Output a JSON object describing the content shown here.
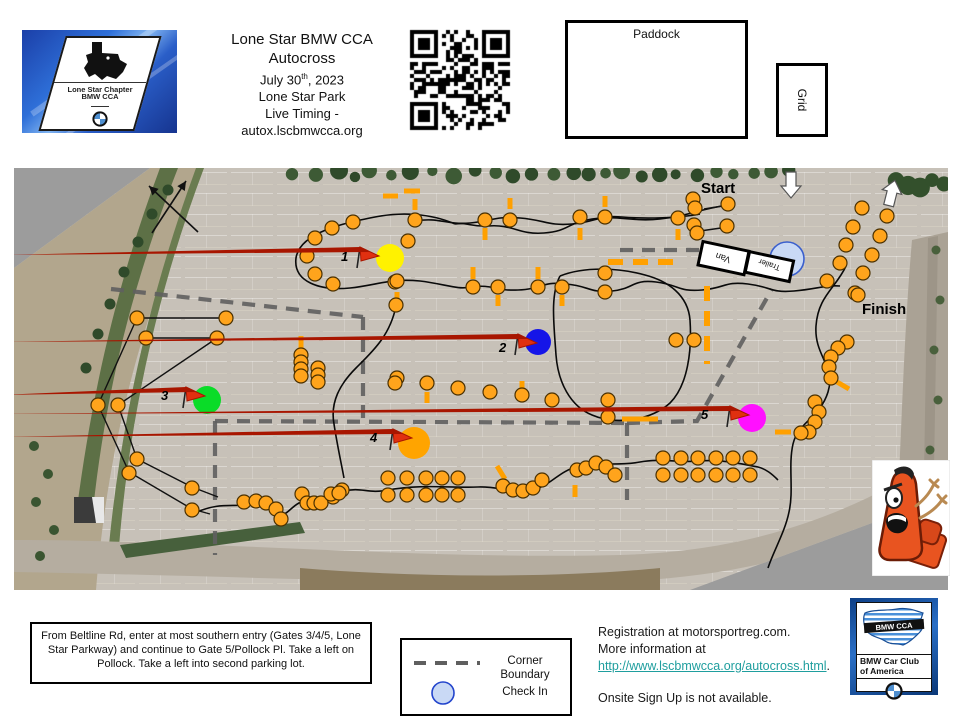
{
  "header": {
    "title_line1": "Lone Star BMW CCA",
    "title_line2": "Autocross",
    "date_prefix": "July 30",
    "date_sup": "th",
    "date_suffix": ", 2023",
    "venue": "Lone Star Park",
    "timing_label": "Live Timing -",
    "timing_url": "autox.lscbmwcca.org",
    "paddock_label": "Paddock",
    "grid_label": "Grid",
    "club_logo_line1": "Lone Star Chapter",
    "club_logo_line2": "BMW CCA"
  },
  "map": {
    "labels": {
      "start": "Start",
      "finish": "Finish",
      "van": "Van",
      "trailer": "Trailer"
    },
    "colors": {
      "cone": "#FFA41C",
      "cone_stroke": "#4a3000",
      "dash": "#FFA000",
      "boundary": "#5f5f5f",
      "course": "#0a0a0a",
      "checkin_fill": "#C9D9F5",
      "checkin_stroke": "#3A5FCD",
      "flag": "#E03010",
      "flag_dark": "#A81600"
    },
    "stations": [
      {
        "n": "1",
        "x": 390,
        "y": 258,
        "r": 14,
        "color": "#FFF200",
        "flag": [
          357,
          268
        ],
        "num": [
          341,
          261
        ]
      },
      {
        "n": "2",
        "x": 538,
        "y": 342,
        "r": 13,
        "color": "#1515E8",
        "flag": [
          515,
          355
        ],
        "num": [
          499,
          352
        ]
      },
      {
        "n": "3",
        "x": 207,
        "y": 400,
        "r": 14,
        "color": "#0ADC28",
        "flag": [
          183,
          408
        ],
        "num": [
          161,
          400
        ]
      },
      {
        "n": "4",
        "x": 414,
        "y": 443,
        "r": 16,
        "color": "#FFA400",
        "flag": [
          390,
          450
        ],
        "num": [
          370,
          442
        ]
      },
      {
        "n": "5",
        "x": 752,
        "y": 418,
        "r": 14,
        "color": "#FF10FF",
        "flag": [
          727,
          427
        ],
        "num": [
          701,
          419
        ]
      }
    ],
    "checkin": {
      "x": 787,
      "y": 259,
      "r": 17
    },
    "van_box": {
      "x": 700,
      "y": 246,
      "w": 47,
      "h": 24,
      "rot": 12
    },
    "trailer_box": {
      "x": 747,
      "y": 256,
      "w": 45,
      "h": 21,
      "rot": 12
    },
    "start_label_pos": [
      701,
      193
    ],
    "finish_label_pos": [
      862,
      314
    ],
    "white_arrows": [
      {
        "x": 791,
        "y": 186,
        "dir": "down",
        "rot": 0
      },
      {
        "x": 892,
        "y": 192,
        "dir": "up",
        "rot": 14
      }
    ],
    "cross_arrows": [
      [
        152,
        233,
        186,
        181
      ],
      [
        198,
        232,
        149,
        186
      ]
    ],
    "boundaries": [
      [
        [
          111,
          289
        ],
        [
          363,
          317
        ]
      ],
      [
        [
          363,
          317
        ],
        [
          363,
          423
        ]
      ],
      [
        [
          215,
          421
        ],
        [
          627,
          423
        ]
      ],
      [
        [
          215,
          421
        ],
        [
          215,
          555
        ]
      ],
      [
        [
          627,
          423
        ],
        [
          627,
          500
        ]
      ],
      [
        [
          627,
          423
        ],
        [
          697,
          421
        ],
        [
          772,
          289
        ]
      ],
      [
        [
          620,
          250
        ],
        [
          700,
          250
        ]
      ]
    ],
    "course_paths": [
      "M728,205 C700,209 688,216 660,219 C632,222 618,215 592,219 C566,223 570,231 544,233 C518,235 514,224 488,226 C470,227 468,222 455,224",
      "M455,224 C430,213 400,212 375,217 C345,223 300,232 296,258 C293,282 320,291 350,288 C378,285 390,278 420,281 C445,284 458,290 470,287 C495,284 492,291 518,290 C544,289 540,281 566,284 C590,286 588,293 612,291 C634,289 632,279 656,282 C680,285 678,292 702,290 C726,288 724,281 748,284 C772,287 770,293 794,291 C818,289 824,285 840,286",
      "M415,221 C440,217 445,225 470,223 C492,221 495,216 520,218 C545,220 548,226 572,224 C596,222 598,215 622,217 C646,219 680,218 700,214",
      "M560,276 C585,266 620,268 645,275 C668,281 688,295 690,320 C692,350 688,385 670,403 C650,421 615,425 592,415 C570,406 558,382 556,355 C554,325 550,295 560,276",
      "M846,266 C836,288 818,296 816,326 C814,356 836,366 828,392 C820,418 798,422 793,444 C788,466 794,490 789,512 C785,532 773,552 768,568",
      "M195,513 C220,501 236,508 250,504 C264,500 268,509 278,514 C288,519 293,499 310,501 C325,503 330,494 344,491 C362,487 368,494 388,490 C420,484 450,488 478,487 C500,486 516,495 536,489 C552,484 560,470 580,466 C600,462 620,466 640,462 C660,458 680,463 700,461 C720,459 742,464 758,467 C766,469 772,474 778,480",
      "M396,306 C390,336 372,352 356,368 C340,384 330,402 334,424 C337,444 341,462 344,478"
    ],
    "gate_lines": [
      [
        137,
        318,
        226,
        318
      ],
      [
        146,
        338,
        217,
        338
      ],
      [
        704,
        209,
        729,
        205
      ],
      [
        700,
        231,
        728,
        227
      ],
      [
        137,
        318,
        98,
        405
      ],
      [
        217,
        338,
        118,
        405
      ],
      [
        98,
        405,
        129,
        472
      ],
      [
        118,
        405,
        137,
        459
      ],
      [
        129,
        472,
        192,
        509
      ],
      [
        137,
        459,
        192,
        487
      ],
      [
        192,
        487,
        218,
        497
      ],
      [
        192,
        509,
        210,
        514
      ]
    ],
    "dashes": [
      [
        383,
        196,
        398,
        196
      ],
      [
        404,
        191,
        420,
        191
      ],
      [
        415,
        199,
        415,
        210
      ],
      [
        510,
        198,
        510,
        209
      ],
      [
        605,
        196,
        605,
        207
      ],
      [
        485,
        228,
        485,
        240
      ],
      [
        580,
        228,
        580,
        240
      ],
      [
        678,
        229,
        678,
        240
      ],
      [
        473,
        267,
        473,
        279
      ],
      [
        538,
        267,
        538,
        279
      ],
      [
        397,
        292,
        397,
        303
      ],
      [
        498,
        295,
        498,
        306
      ],
      [
        562,
        295,
        562,
        306
      ],
      [
        608,
        262,
        676,
        262
      ],
      [
        707,
        286,
        707,
        364
      ],
      [
        622,
        419,
        658,
        419
      ],
      [
        301,
        336,
        301,
        350
      ],
      [
        775,
        432,
        791,
        432
      ],
      [
        837,
        382,
        849,
        389
      ],
      [
        497,
        466,
        505,
        479
      ],
      [
        575,
        485,
        575,
        497
      ],
      [
        427,
        392,
        427,
        403
      ],
      [
        522,
        381,
        522,
        391
      ]
    ],
    "cones": [
      [
        693,
        199
      ],
      [
        695,
        208
      ],
      [
        728,
        204
      ],
      [
        694,
        225
      ],
      [
        697,
        233
      ],
      [
        727,
        226
      ],
      [
        415,
        220
      ],
      [
        485,
        220
      ],
      [
        510,
        220
      ],
      [
        580,
        217
      ],
      [
        605,
        217
      ],
      [
        678,
        218
      ],
      [
        332,
        228
      ],
      [
        353,
        222
      ],
      [
        315,
        238
      ],
      [
        307,
        256
      ],
      [
        315,
        274
      ],
      [
        333,
        284
      ],
      [
        408,
        241
      ],
      [
        395,
        282
      ],
      [
        396,
        305
      ],
      [
        397,
        378
      ],
      [
        397,
        281
      ],
      [
        473,
        287
      ],
      [
        498,
        287
      ],
      [
        538,
        287
      ],
      [
        562,
        287
      ],
      [
        605,
        273
      ],
      [
        605,
        292
      ],
      [
        676,
        340
      ],
      [
        694,
        340
      ],
      [
        608,
        400
      ],
      [
        608,
        417
      ],
      [
        301,
        355
      ],
      [
        301,
        362
      ],
      [
        301,
        369
      ],
      [
        301,
        376
      ],
      [
        318,
        368
      ],
      [
        318,
        375
      ],
      [
        318,
        382
      ],
      [
        137,
        318
      ],
      [
        226,
        318
      ],
      [
        146,
        338
      ],
      [
        217,
        338
      ],
      [
        98,
        405
      ],
      [
        118,
        405
      ],
      [
        137,
        459
      ],
      [
        129,
        473
      ],
      [
        192,
        488
      ],
      [
        192,
        510
      ],
      [
        388,
        478
      ],
      [
        407,
        478
      ],
      [
        426,
        478
      ],
      [
        442,
        478
      ],
      [
        458,
        478
      ],
      [
        388,
        495
      ],
      [
        407,
        495
      ],
      [
        426,
        495
      ],
      [
        442,
        495
      ],
      [
        458,
        495
      ],
      [
        503,
        486
      ],
      [
        513,
        490
      ],
      [
        523,
        491
      ],
      [
        533,
        488
      ],
      [
        542,
        480
      ],
      [
        577,
        470
      ],
      [
        586,
        468
      ],
      [
        596,
        463
      ],
      [
        606,
        467
      ],
      [
        615,
        475
      ],
      [
        342,
        490
      ],
      [
        333,
        497
      ],
      [
        244,
        502
      ],
      [
        256,
        501
      ],
      [
        266,
        503
      ],
      [
        276,
        509
      ],
      [
        281,
        519
      ],
      [
        302,
        494
      ],
      [
        307,
        503
      ],
      [
        314,
        503
      ],
      [
        321,
        503
      ],
      [
        331,
        494
      ],
      [
        339,
        493
      ],
      [
        395,
        383
      ],
      [
        427,
        383
      ],
      [
        458,
        388
      ],
      [
        490,
        392
      ],
      [
        522,
        395
      ],
      [
        552,
        400
      ],
      [
        663,
        458
      ],
      [
        681,
        458
      ],
      [
        698,
        458
      ],
      [
        716,
        458
      ],
      [
        733,
        458
      ],
      [
        750,
        458
      ],
      [
        663,
        475
      ],
      [
        681,
        475
      ],
      [
        698,
        475
      ],
      [
        716,
        475
      ],
      [
        733,
        475
      ],
      [
        750,
        475
      ],
      [
        862,
        208
      ],
      [
        887,
        216
      ],
      [
        853,
        227
      ],
      [
        880,
        236
      ],
      [
        846,
        245
      ],
      [
        872,
        255
      ],
      [
        840,
        263
      ],
      [
        863,
        273
      ],
      [
        827,
        281
      ],
      [
        855,
        293
      ],
      [
        858,
        295
      ],
      [
        847,
        342
      ],
      [
        838,
        348
      ],
      [
        831,
        357
      ],
      [
        829,
        367
      ],
      [
        831,
        378
      ],
      [
        815,
        402
      ],
      [
        819,
        412
      ],
      [
        815,
        422
      ],
      [
        809,
        432
      ],
      [
        801,
        433
      ]
    ]
  },
  "footer": {
    "directions": "From Beltline Rd, enter at most southern entry (Gates 3/4/5, Lone Star Parkway) and continue to Gate 5/Pollock Pl.  Take a left on Pollock.  Take a left into second parking lot.",
    "legend_corner_boundary": "Corner Boundary",
    "legend_check_in": "Check In",
    "registration_line1": "Registration at motorsportreg.com.",
    "registration_line2": "More information at",
    "registration_link": "http://www.lscbmwcca.org/autocross.html",
    "registration_link_suffix": ".",
    "onsite": "Onsite Sign Up is not available.",
    "link_color": "#1F9E9E",
    "bmwcca_banner": "BMW CCA",
    "bmwcca_line1": "BMW Car Club",
    "bmwcca_line2": "of America"
  }
}
